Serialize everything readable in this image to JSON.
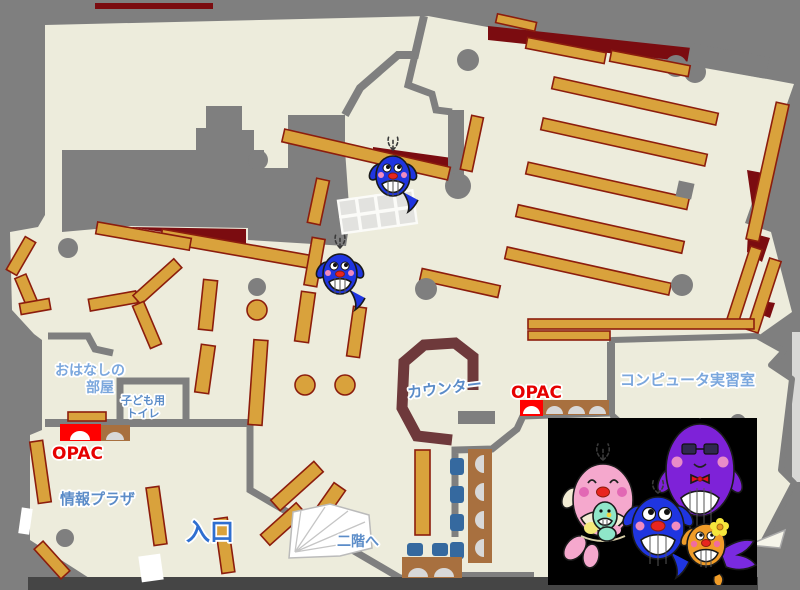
{
  "app": {
    "title": "library-floor-map"
  },
  "labels": {
    "story_room_line1": "おはなしの",
    "story_room_line2": "部屋",
    "kids_toilet_line1": "子ども用",
    "kids_toilet_line2": "トイレ",
    "opac_left": "OPAC",
    "info_plaza": "情報プラザ",
    "entrance": "入口",
    "to_second_floor": "二階へ",
    "counter": "カウンター",
    "opac_right": "OPAC",
    "computer_room": "コンピュータ実習室"
  },
  "palette": {
    "background_gray": "#7f7f7f",
    "floor_cream": "#edecdc",
    "shelf_orange": "#d9a23c",
    "shelf_border": "#8c1d0d",
    "dark_red": "#7b0c10",
    "counter_maroon": "#6e393b",
    "desk_brown": "#a8703f",
    "chair_blue": "#35699f",
    "opac_red": "#ff0000",
    "label_blue": "#5b8cc8",
    "label_light_blue": "#7ba7dd",
    "label_red": "#e60000",
    "entrance_blue": "#2f6fd0",
    "mascot_blue": "#1f35e0",
    "mascot_pink": "#f5a8cd",
    "mascot_purple": "#7e22d8",
    "mascot_orange": "#f09c28",
    "photo_black": "#000000"
  },
  "icons": {
    "whale_small": "blue-whale-mascot",
    "whale_mother": "pink-mother-whale-mascot",
    "whale_father": "purple-father-whale-mascot",
    "whale_child": "blue-child-whale-mascot",
    "whale_orange": "orange-whale-mascot",
    "stairs": "stairs-fan-icon",
    "opac_terminal": "opac-terminal-icon"
  }
}
